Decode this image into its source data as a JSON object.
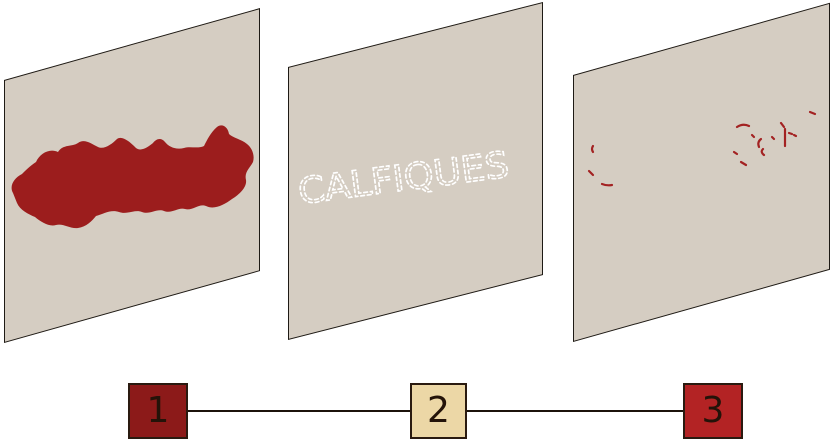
{
  "palette": {
    "bg": "#ffffff",
    "panel_fill": "#d5cdc2",
    "ink": "#1e1a15",
    "blob_red": "#9c1d1d",
    "marks_red": "#a32222",
    "graffiti_white": "#ffffff",
    "line_color": "#1c130b",
    "node1_fill": "#8c1a19",
    "node2_fill": "#ecd7a6",
    "node3_fill": "#b32324",
    "node_border": "#2a1a10",
    "digit_color": "#241309"
  },
  "panels": [
    {
      "name": "wall-panel-stage-1",
      "content_icon": "red-paint-blob-shape"
    },
    {
      "name": "wall-panel-stage-2",
      "content_icon": "dashed-white-graffiti-text"
    },
    {
      "name": "wall-panel-stage-3",
      "content_icon": "faded-red-paint-traces"
    }
  ],
  "graffiti": {
    "text": "CALFIQUES"
  },
  "timeline": {
    "nodes": [
      {
        "label": "1"
      },
      {
        "label": "2"
      },
      {
        "label": "3"
      }
    ]
  }
}
